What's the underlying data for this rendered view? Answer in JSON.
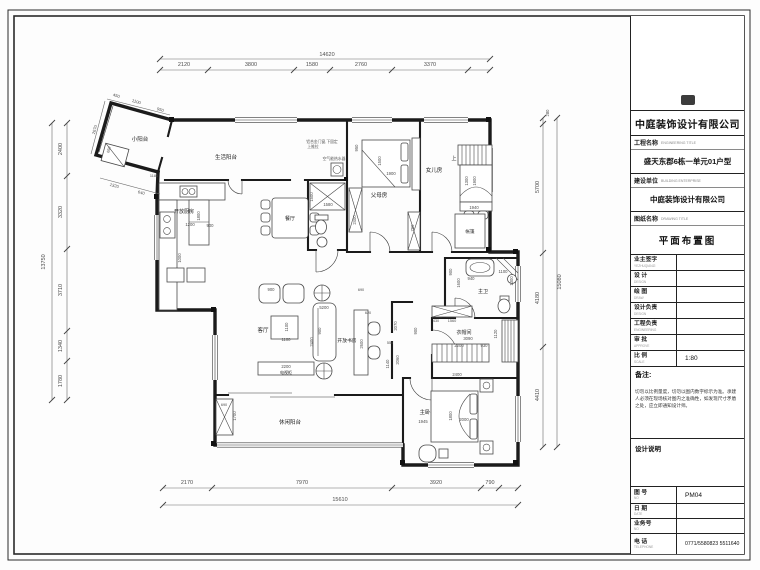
{
  "title_block": {
    "company": "中庭装饰设计有限公司",
    "project_label": "工程名称",
    "project_label_en": "ENGINEERING TITLE",
    "project_value": "盛天东郡6栋一单元01户型",
    "builder_label": "建设单位",
    "builder_label_en": "BUILDING ENTERPRISE",
    "builder_value": "中庭装饰设计有限公司",
    "drawing_label": "图纸名称",
    "drawing_label_en": "DRAWING TITLE",
    "drawing_value": "平面布置图",
    "rows": [
      {
        "label": "业主签字",
        "en": "YEZHUQIANZI",
        "value": ""
      },
      {
        "label": "设  计",
        "en": "DESIGN",
        "value": ""
      },
      {
        "label": "绘  图",
        "en": "DRAW",
        "value": ""
      },
      {
        "label": "设计负责",
        "en": "DESIGN",
        "value": ""
      },
      {
        "label": "工程负责",
        "en": "ENGINEERING",
        "value": ""
      },
      {
        "label": "审  批",
        "en": "APPROVE",
        "value": ""
      },
      {
        "label": "比  例",
        "en": "SCALE",
        "value": "1:80"
      }
    ],
    "remark_label": "备注:",
    "remark_text": "切勿以比例量度，切勿以图内数字标示为准。承建人必须在现场核对图内之准确性，如发现尺寸矛盾之处，应立即通知设计师。",
    "design_note_label": "设计说明",
    "footer_rows": [
      {
        "label": "图 号",
        "en": "NO",
        "value": "PM04"
      },
      {
        "label": "日 期",
        "en": "DATE",
        "value": ""
      },
      {
        "label": "业务号",
        "en": "NO",
        "value": ""
      },
      {
        "label": "电 话",
        "en": "TELEPHONE",
        "value": "0771/5580823  5511640"
      }
    ]
  },
  "plan": {
    "scale": "1:80",
    "texts": [
      {
        "t": "小阳台",
        "x": 140,
        "y": 141,
        "s": 5.5,
        "c": "room",
        "n": "room-label-small-balcony"
      },
      {
        "t": "生活阳台",
        "x": 226,
        "y": 159,
        "s": 5.5,
        "c": "room",
        "n": "room-label-service-balcony"
      },
      {
        "t": "开放厨房",
        "x": 184,
        "y": 213,
        "s": 5,
        "c": "room",
        "n": "room-label-open-kitchen"
      },
      {
        "t": "餐厅",
        "x": 290,
        "y": 220,
        "s": 5,
        "c": "room",
        "n": "room-label-dining"
      },
      {
        "t": "父母房",
        "x": 379,
        "y": 197,
        "s": 5.5,
        "c": "room",
        "n": "room-label-parents-room"
      },
      {
        "t": "女儿房",
        "x": 434,
        "y": 172,
        "s": 5.5,
        "c": "room",
        "n": "room-label-daughter-room"
      },
      {
        "t": "帐篷",
        "x": 470,
        "y": 233,
        "s": 4.5,
        "c": "room",
        "n": "label-tent"
      },
      {
        "t": "主卫",
        "x": 483,
        "y": 293,
        "s": 5,
        "c": "room",
        "n": "room-label-master-bath"
      },
      {
        "t": "衣帽间",
        "x": 464,
        "y": 334,
        "s": 5,
        "c": "room",
        "n": "room-label-cloakroom"
      },
      {
        "t": "主卧",
        "x": 425,
        "y": 414,
        "s": 5.5,
        "c": "room",
        "n": "room-label-master-bedroom"
      },
      {
        "t": "客厅",
        "x": 263,
        "y": 332,
        "s": 5.5,
        "c": "room",
        "n": "room-label-living-room"
      },
      {
        "t": "开放书房",
        "x": 347,
        "y": 342,
        "s": 4.8,
        "c": "room",
        "n": "room-label-open-study"
      },
      {
        "t": "休闲阳台",
        "x": 290,
        "y": 424,
        "s": 5.5,
        "c": "room",
        "n": "room-label-leisure-balcony"
      },
      {
        "t": "电视柜",
        "x": 286,
        "y": 374,
        "s": 4,
        "c": "room",
        "n": "label-tv-cabinet"
      },
      {
        "t": "上",
        "x": 454,
        "y": 160,
        "s": 5,
        "c": "room",
        "n": "label-stairs-up"
      },
      {
        "t": "铝合金门窗,下固定",
        "x": 322,
        "y": 143,
        "s": 3.8,
        "c": "note",
        "n": "note-window"
      },
      {
        "t": "上推拉",
        "x": 313,
        "y": 148,
        "s": 3.8,
        "c": "note",
        "n": "note-window-2"
      },
      {
        "t": "空气能热水器",
        "x": 334,
        "y": 160,
        "s": 3.8,
        "c": "note",
        "n": "note-heater"
      },
      {
        "t": "14620",
        "x": 327,
        "y": 56,
        "s": 5.5
      },
      {
        "t": "2120",
        "x": 184,
        "y": 66,
        "s": 5.5
      },
      {
        "t": "3800",
        "x": 251,
        "y": 66,
        "s": 5.5
      },
      {
        "t": "1580",
        "x": 312,
        "y": 66,
        "s": 5.5
      },
      {
        "t": "2760",
        "x": 361,
        "y": 66,
        "s": 5.5
      },
      {
        "t": "3370",
        "x": 430,
        "y": 66,
        "s": 5.5
      },
      {
        "t": "15610",
        "x": 340,
        "y": 501,
        "s": 5.5
      },
      {
        "t": "2170",
        "x": 187,
        "y": 484,
        "s": 5.5
      },
      {
        "t": "7970",
        "x": 302,
        "y": 484,
        "s": 5.5
      },
      {
        "t": "3920",
        "x": 436,
        "y": 484,
        "s": 5.5
      },
      {
        "t": "790",
        "x": 490,
        "y": 484,
        "s": 5.5
      },
      {
        "t": "13750",
        "x": 45,
        "y": 262,
        "r": -90,
        "s": 5.5
      },
      {
        "t": "2400",
        "x": 62,
        "y": 149,
        "r": -90,
        "s": 5.5
      },
      {
        "t": "3320",
        "x": 62,
        "y": 212,
        "r": -90,
        "s": 5.5
      },
      {
        "t": "3710",
        "x": 62,
        "y": 290,
        "r": -90,
        "s": 5.5
      },
      {
        "t": "1340",
        "x": 62,
        "y": 346,
        "r": -90,
        "s": 5.5
      },
      {
        "t": "1780",
        "x": 62,
        "y": 381,
        "r": -90,
        "s": 5.5
      },
      {
        "t": "15080",
        "x": 561,
        "y": 282,
        "r": -90,
        "s": 5.5
      },
      {
        "t": "280",
        "x": 549,
        "y": 113,
        "r": -90,
        "s": 4.2
      },
      {
        "t": "5700",
        "x": 539,
        "y": 187,
        "r": -90,
        "s": 5.5
      },
      {
        "t": "4180",
        "x": 539,
        "y": 298,
        "r": -90,
        "s": 5.5
      },
      {
        "t": "4410",
        "x": 539,
        "y": 395,
        "r": -90,
        "s": 5.5
      },
      {
        "t": "450",
        "x": 116,
        "y": 97,
        "r": 16,
        "s": 4.2
      },
      {
        "t": "1100",
        "x": 136,
        "y": 103,
        "r": 16,
        "s": 4.2
      },
      {
        "t": "950",
        "x": 160,
        "y": 111,
        "r": 16,
        "s": 4.2
      },
      {
        "t": "2670",
        "x": 96,
        "y": 130,
        "r": -74,
        "s": 4.2
      },
      {
        "t": "1320",
        "x": 114,
        "y": 187,
        "r": 15,
        "s": 4.2
      },
      {
        "t": "640",
        "x": 141,
        "y": 194,
        "r": 15,
        "s": 4.2
      },
      {
        "t": "1180",
        "x": 154,
        "y": 177,
        "s": 3.8
      },
      {
        "t": "650",
        "x": 110,
        "y": 150,
        "r": -74,
        "s": 3.8
      },
      {
        "t": "1200",
        "x": 190,
        "y": 226,
        "s": 4.2
      },
      {
        "t": "900",
        "x": 210,
        "y": 227,
        "s": 4.2
      },
      {
        "t": "1800",
        "x": 200,
        "y": 216,
        "r": -90,
        "s": 4.2
      },
      {
        "t": "1000",
        "x": 181,
        "y": 258,
        "r": -90,
        "s": 4.2
      },
      {
        "t": "1500",
        "x": 313,
        "y": 197,
        "r": -90,
        "s": 4.2
      },
      {
        "t": "1580",
        "x": 328,
        "y": 206,
        "s": 4.2
      },
      {
        "t": "1900",
        "x": 391,
        "y": 175,
        "s": 4.2
      },
      {
        "t": "1500",
        "x": 381,
        "y": 161,
        "r": -90,
        "s": 4.2
      },
      {
        "t": "950",
        "x": 358,
        "y": 148,
        "r": -90,
        "s": 4.2
      },
      {
        "t": "2400",
        "x": 356,
        "y": 220,
        "r": -90,
        "s": 4.2
      },
      {
        "t": "1300",
        "x": 468,
        "y": 181,
        "r": -90,
        "s": 4.2
      },
      {
        "t": "1900",
        "x": 476,
        "y": 181,
        "r": -90,
        "s": 4.2
      },
      {
        "t": "1940",
        "x": 474,
        "y": 209,
        "s": 4.2
      },
      {
        "t": "750",
        "x": 414,
        "y": 228,
        "r": -90,
        "s": 4.2
      },
      {
        "t": "900",
        "x": 452,
        "y": 272,
        "r": -90,
        "s": 4.2
      },
      {
        "t": "1600",
        "x": 460,
        "y": 283,
        "r": -90,
        "s": 4.2
      },
      {
        "t": "940",
        "x": 471,
        "y": 280,
        "s": 4.2
      },
      {
        "t": "1100",
        "x": 503,
        "y": 273,
        "s": 4.2
      },
      {
        "t": "1300",
        "x": 513,
        "y": 281,
        "r": -90,
        "s": 4.2
      },
      {
        "t": "3090",
        "x": 468,
        "y": 340,
        "s": 4.2
      },
      {
        "t": "2200",
        "x": 459,
        "y": 347,
        "s": 4.2
      },
      {
        "t": "930",
        "x": 484,
        "y": 347,
        "s": 4.2
      },
      {
        "t": "1120",
        "x": 497,
        "y": 334,
        "r": -90,
        "s": 4.2
      },
      {
        "t": "430",
        "x": 436,
        "y": 322,
        "s": 3.8
      },
      {
        "t": "1560",
        "x": 452,
        "y": 322,
        "s": 3.8
      },
      {
        "t": "1800",
        "x": 452,
        "y": 416,
        "r": -90,
        "s": 4.2
      },
      {
        "t": "2000",
        "x": 464,
        "y": 421,
        "s": 4.2
      },
      {
        "t": "1945",
        "x": 423,
        "y": 423,
        "s": 4.2
      },
      {
        "t": "2400",
        "x": 457,
        "y": 376,
        "s": 4.2
      },
      {
        "t": "5200",
        "x": 324,
        "y": 309,
        "s": 4.2
      },
      {
        "t": "1100",
        "x": 288,
        "y": 327,
        "r": -90,
        "s": 4.2
      },
      {
        "t": "1100",
        "x": 286,
        "y": 341,
        "s": 4.2
      },
      {
        "t": "900",
        "x": 321,
        "y": 331,
        "r": -90,
        "s": 4.2
      },
      {
        "t": "2400",
        "x": 313,
        "y": 342,
        "r": -90,
        "s": 4.2
      },
      {
        "t": "900",
        "x": 271,
        "y": 291,
        "s": 4.2
      },
      {
        "t": "2200",
        "x": 286,
        "y": 368,
        "s": 4.2
      },
      {
        "t": "2600",
        "x": 363,
        "y": 344,
        "r": -90,
        "s": 4.2
      },
      {
        "t": "2070",
        "x": 397,
        "y": 326,
        "r": -90,
        "s": 4.2
      },
      {
        "t": "550",
        "x": 390,
        "y": 344,
        "s": 3.8
      },
      {
        "t": "690",
        "x": 361,
        "y": 291,
        "s": 3.8
      },
      {
        "t": "620",
        "x": 368,
        "y": 314,
        "s": 3.8
      },
      {
        "t": "1140",
        "x": 389,
        "y": 364,
        "r": -90,
        "s": 4.2
      },
      {
        "t": "2060",
        "x": 399,
        "y": 360,
        "r": -90,
        "s": 4.2
      },
      {
        "t": "900",
        "x": 417,
        "y": 331,
        "r": -90,
        "s": 4.2
      },
      {
        "t": "1700",
        "x": 236,
        "y": 416,
        "r": -90,
        "s": 4.2
      },
      {
        "t": "690",
        "x": 224,
        "y": 406,
        "s": 3.8
      }
    ]
  }
}
